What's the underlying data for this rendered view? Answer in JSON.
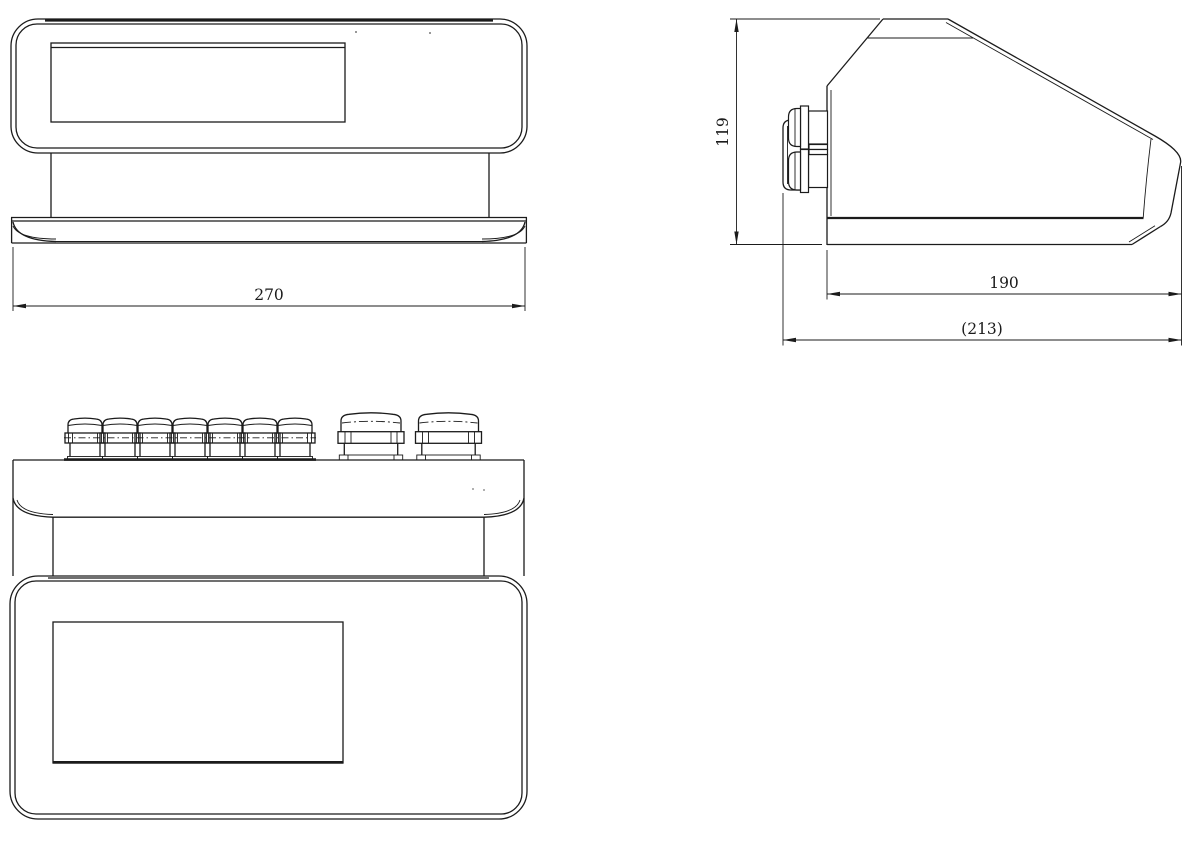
{
  "page": {
    "background_color": "#ffffff",
    "line_color": "#1b1b1b"
  },
  "dims": {
    "front_width": "270",
    "side_height": "119",
    "side_depth": "190",
    "side_overall_depth": "(213)"
  }
}
